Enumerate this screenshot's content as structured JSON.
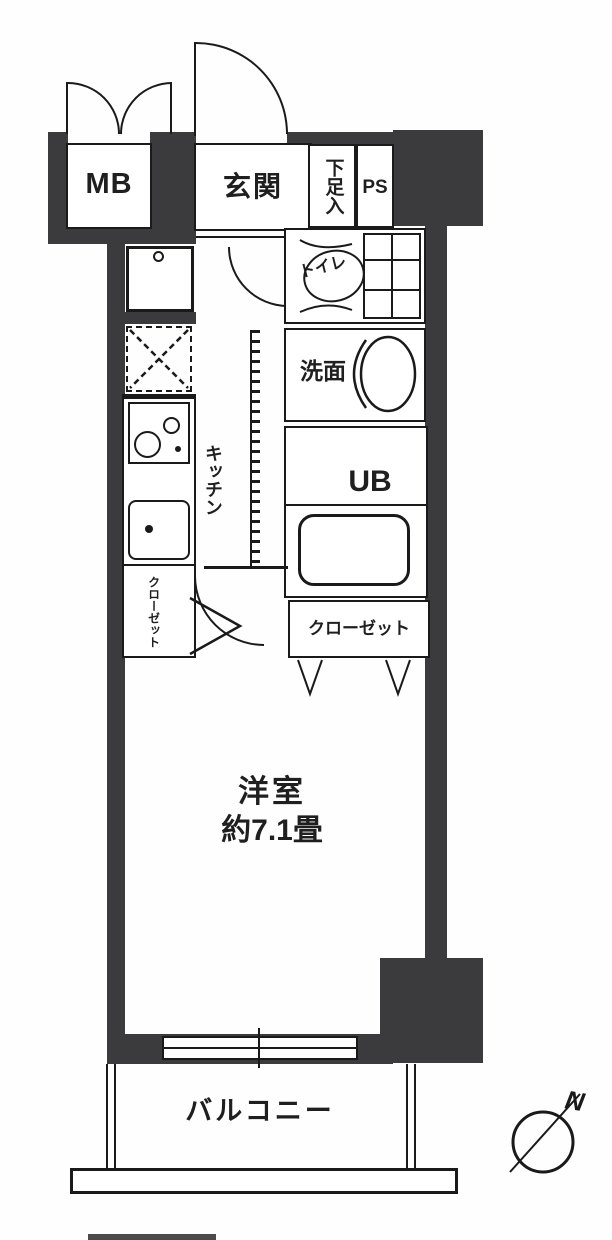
{
  "title": "apartment-floor-plan",
  "colors": {
    "wall": "#3b3b3d",
    "line": "#1a1a1a",
    "background": "#ffffff"
  },
  "labels": {
    "mb": "MB",
    "entrance": "玄関",
    "shoe_box": "下足入",
    "ps": "PS",
    "toilet": "トイレ",
    "washroom": "洗面",
    "unit_bath": "UB",
    "kitchen": "キッチン",
    "closet_left": "クローゼット",
    "closet_right": "クローゼット",
    "main_room": "洋室",
    "main_room_size": "約7.1畳",
    "balcony": "バルコニー",
    "compass_north": "N"
  }
}
